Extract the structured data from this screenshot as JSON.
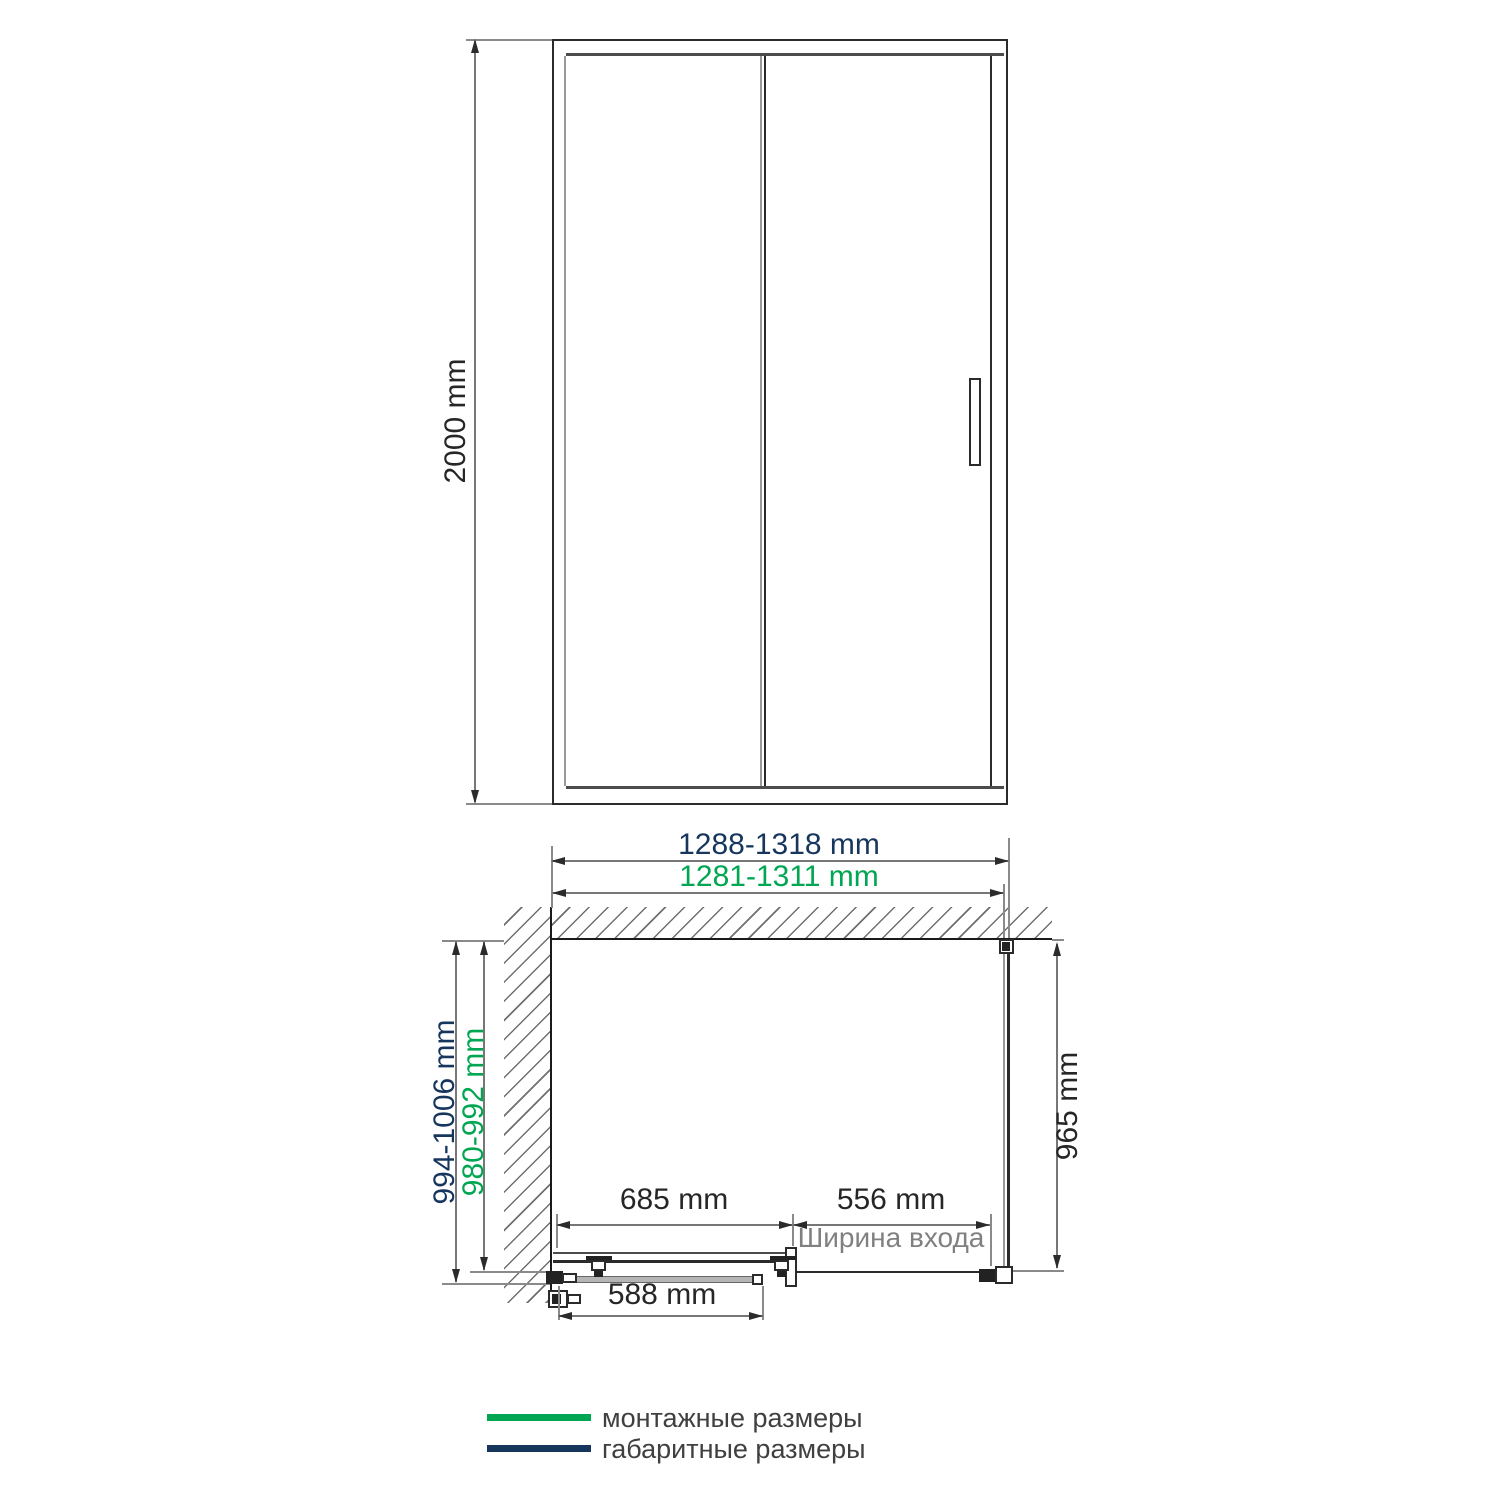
{
  "drawing": {
    "title": "shower-enclosure-dimension-diagram",
    "front_view": {
      "height_dim": "2000 mm"
    },
    "plan_view": {
      "overall_width_dim": "1288-1318 mm",
      "mounting_width_dim": "1281-1311 mm",
      "overall_depth_dim": "994-1006 mm",
      "mounting_depth_dim": "980-992 mm",
      "side_panel_dim": "965 mm",
      "fixed_panel_dim": "685 mm",
      "entry_width_dim": "556 mm",
      "entry_width_caption": "Ширина входа",
      "door_width_dim": "588 mm"
    },
    "legend": {
      "mounting": {
        "label": "монтажные размеры",
        "color": "#00A651"
      },
      "overall": {
        "label": "габаритные размеры",
        "color": "#17365D"
      }
    },
    "colors": {
      "mounting_green": "#00A651",
      "overall_navy": "#17365D",
      "caption_gray": "#808080",
      "line_black": "#2B2B2B",
      "glass_gray": "#999999"
    }
  }
}
